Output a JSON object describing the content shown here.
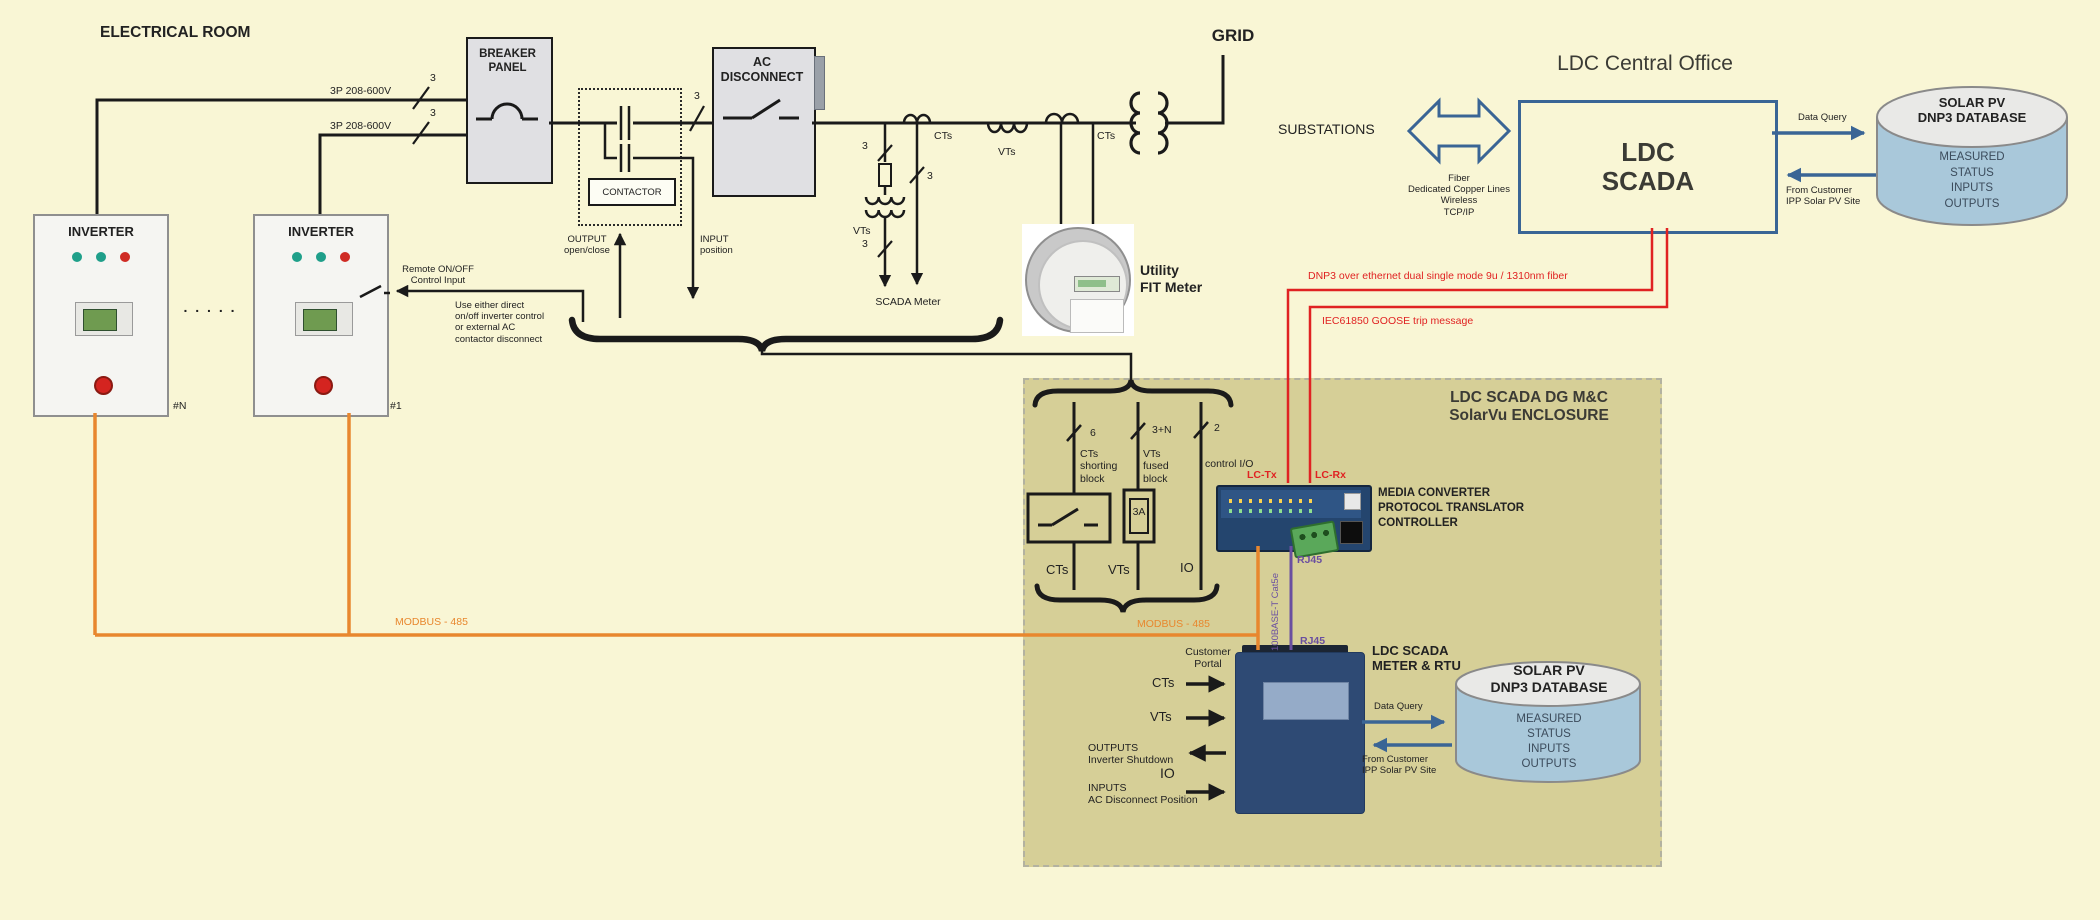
{
  "er": {
    "title": "ELECTRICAL ROOM"
  },
  "feed": {
    "l1": "3P 208-600V",
    "l2": "3P 208-600V",
    "n1": "3",
    "n2": "3",
    "n3": "3"
  },
  "bp": {
    "l1": "BREAKER",
    "l2": "PANEL"
  },
  "cont": {
    "label": "CONTACTOR",
    "out1": "OUTPUT",
    "out2": "open/close",
    "in1": "INPUT",
    "in2": "position"
  },
  "acd": {
    "l1": "AC",
    "l2": "DISCONNECT"
  },
  "sm": {
    "n1": "3",
    "n2": "3",
    "n3": "3",
    "vts": "VTs",
    "label": "SCADA Meter"
  },
  "ln": {
    "cts1": "CTs",
    "vts": "VTs",
    "cts2": "CTs"
  },
  "grid": "GRID",
  "fit": {
    "l1": "Utility",
    "l2": "FIT Meter"
  },
  "inv": {
    "title": "INVERTER",
    "n": "#N",
    "one": "#1",
    "dots": ". . . . .",
    "rm1": "Remote ON/OFF",
    "rm2": "Control Input",
    "note1": "Use either direct",
    "note2": "on/off inverter control",
    "note3": "or external AC",
    "note4": "contactor disconnect"
  },
  "co": {
    "title": "LDC Central Office",
    "subs": "SUBSTATIONS",
    "lk1": "Fiber",
    "lk2": "Dedicated Copper Lines",
    "lk3": "Wireless",
    "lk4": "TCP/IP",
    "s1": "LDC",
    "s2": "SCADA",
    "dq": "Data Query",
    "fc1": "From Customer",
    "fc2": "IPP Solar PV Site"
  },
  "dbt": {
    "t1": "SOLAR PV",
    "t2": "DNP3 DATABASE",
    "r1": "MEASURED",
    "r2": "STATUS",
    "r3": "INPUTS",
    "r4": "OUTPUTS"
  },
  "red": {
    "dnp3": "DNP3 over ethernet dual single mode 9u / 1310nm  fiber",
    "goose": "IEC61850 GOOSE trip message",
    "tx": "LC-Tx",
    "rx": "LC-Rx"
  },
  "enc": {
    "t1": "LDC SCADA DG M&C",
    "t2": "SolarVu ENCLOSURE",
    "n1": "6",
    "n2": "3+N",
    "n3": "2",
    "w1a": "CTs",
    "w1b": "shorting",
    "w1c": "block",
    "w2a": "VTs",
    "w2b": "fused",
    "w2c": "block",
    "w3": "control I/O",
    "fuse": "3A",
    "b1": "CTs",
    "b2": "VTs",
    "b3": "IO",
    "m1": "MEDIA CONVERTER",
    "m2": "PROTOCOL TRANSLATOR",
    "m3": "CONTROLLER",
    "rj1": "RJ45",
    "rj2": "RJ45",
    "cat": "100BASE-T  Cat5e",
    "modbus": "MODBUS - 485"
  },
  "modbus_left": "MODBUS - 485",
  "rtu": {
    "t1": "LDC SCADA",
    "t2": "METER & RTU",
    "cp1": "Customer",
    "cp2": "Portal",
    "cts": "CTs",
    "vts": "VTs",
    "o1": "OUTPUTS",
    "o2": "Inverter Shutdown",
    "io": "IO",
    "i1": "INPUTS",
    "i2": "AC Disconnect Position",
    "dq": "Data Query",
    "fc1": "From Customer",
    "fc2": "IPP Solar PV Site"
  },
  "dbb": {
    "t1": "SOLAR PV",
    "t2": "DNP3 DATABASE",
    "r1": "MEASURED",
    "r2": "STATUS",
    "r3": "INPUTS",
    "r4": "OUTPUTS"
  },
  "colors": {
    "bg": "#f9f6d5",
    "enclosure": "#d6cf97",
    "accent_blue": "#3a6595",
    "signal_red": "#e02222",
    "modbus_orange": "#e8872e",
    "ethernet_purple": "#6a4fa0",
    "meter_blue": "#2e4a74",
    "db_body": "#a9c8da"
  }
}
